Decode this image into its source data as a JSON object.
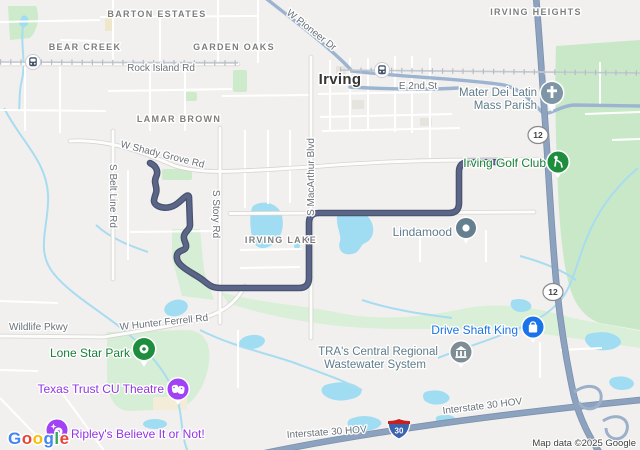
{
  "map": {
    "city": "Irving",
    "neighborhoods": [
      "BARTON ESTATES",
      "BEAR CREEK",
      "GARDEN OAKS",
      "LAMAR BROWN",
      "IRVING HEIGHTS",
      "IRVING LAKE"
    ],
    "road_labels": [
      "W Pioneer Dr",
      "Rock Island Rd",
      "E 2nd St",
      "W Shady Grove Rd",
      "S Belt Line Rd",
      "S Story Rd",
      "S MacArthur Blvd",
      "Wildlife Pkwy",
      "W Hunter Ferrell Rd",
      "Interstate 30 HOV",
      "Interstate 30 HOV"
    ],
    "shields": [
      "12",
      "12",
      "30"
    ],
    "pois": [
      {
        "full_name": "Mater Dei Latin Mass Parish",
        "label_line1": "Mater Dei Latin",
        "label_line2": "Mass Parish",
        "icon": "church-pin",
        "pin_color": "#7e95a6",
        "text_color": "#5f7c8a"
      },
      {
        "name": "Irving Golf Club",
        "icon": "golf-pin",
        "pin_color": "#1e8e3e",
        "text_color": "#188038"
      },
      {
        "name": "Lindamood",
        "icon": "place-pin",
        "pin_color": "#64808f",
        "text_color": "#5f7c8a"
      },
      {
        "name": "Lone Star Park",
        "icon": "park-pin",
        "pin_color": "#1e8e3e",
        "text_color": "#188038"
      },
      {
        "name": "Texas Trust CU Theatre",
        "icon": "theater-pin",
        "pin_color": "#a142f4",
        "text_color": "#9334e6"
      },
      {
        "name": "Ripley's Believe It or Not!",
        "icon": "attraction-pin",
        "pin_color": "#a142f4",
        "text_color": "#9334e6"
      },
      {
        "name": "Drive Shaft King",
        "icon": "shopping-pin",
        "pin_color": "#1a73e8",
        "text_color": "#1a73e8"
      },
      {
        "full_name": "TRA's Central Regional Wastewater System",
        "label_line1": "TRA's Central Regional",
        "label_line2": "Wastewater System",
        "icon": "civic-pin",
        "pin_color": "#7d8c95",
        "text_color": "#5f7c8a"
      }
    ],
    "transit_station_count": 2,
    "route_color": "#515d80",
    "highway_color": "#8da2be",
    "water_color": "#a0dcf2",
    "park_color": "#cdeacb",
    "attribution": "Map data ©2025 Google",
    "logo_letters": [
      "G",
      "o",
      "o",
      "g",
      "l",
      "e"
    ],
    "logo_colors": [
      "#4285F4",
      "#EA4335",
      "#FBBC04",
      "#4285F4",
      "#34A853",
      "#EA4335"
    ]
  }
}
